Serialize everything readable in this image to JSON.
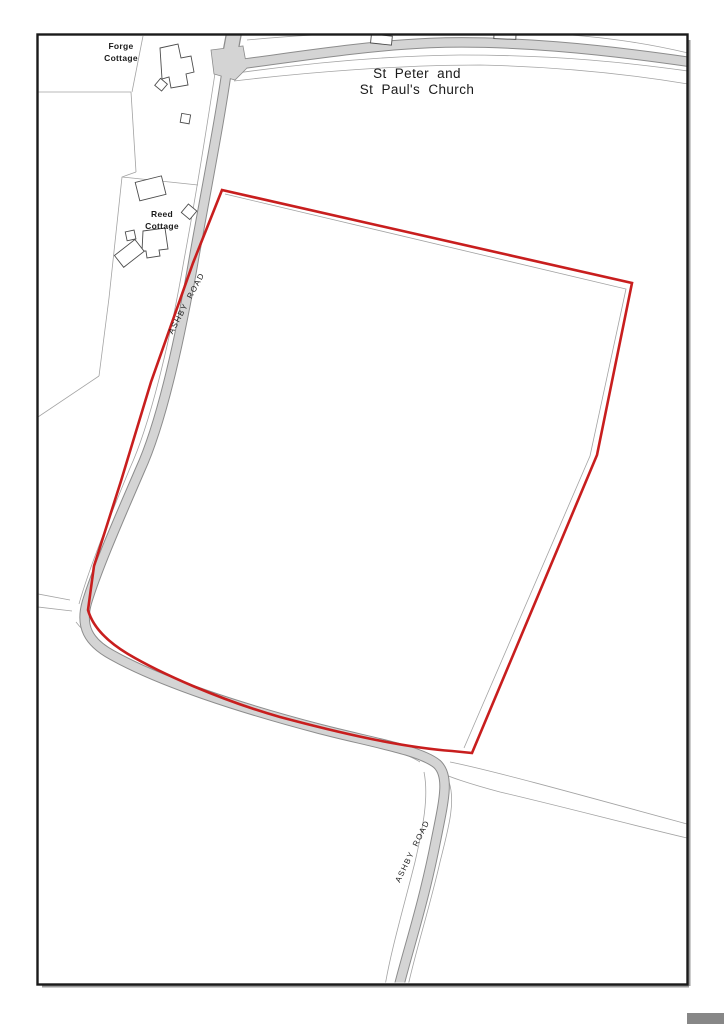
{
  "map": {
    "labels": {
      "forge_cottage_line1": "Forge",
      "forge_cottage_line2": "Cottage",
      "reed_cottage_line1": "Reed",
      "reed_cottage_line2": "Cottage",
      "church_line1": "St Peter and",
      "church_line2": "St Paul's Church",
      "road_name_north": "ASHBY ROAD",
      "road_name_south": "ASHBY ROAD"
    },
    "colors": {
      "boundary_red": "#c81e1e",
      "road_fill": "#d4d4d4",
      "road_casing": "#8c8c8c",
      "field_line": "#a3a3a3",
      "building_outline": "#4d4d4d",
      "frame_border": "#1a1a1a",
      "frame_shadow": "#9a9a9a",
      "scrollbar_gray": "#878787"
    }
  }
}
